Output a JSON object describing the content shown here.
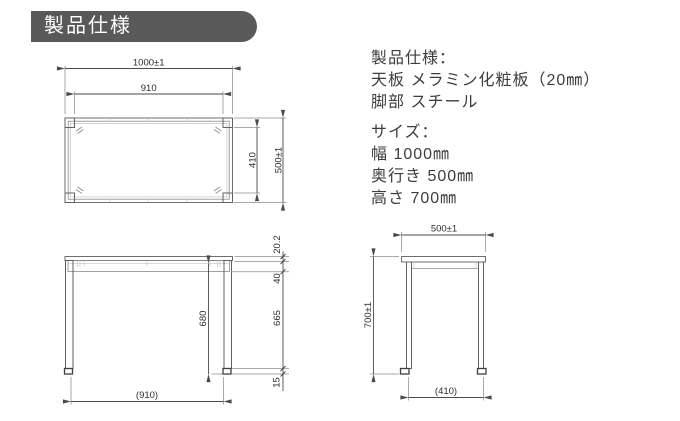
{
  "header": {
    "title": "製品仕様"
  },
  "specs": {
    "heading": "製品仕様：",
    "material_lines": [
      "天板 メラミン化粧板（20㎜）",
      "脚部 スチール"
    ],
    "size_heading": "サイズ：",
    "size_lines": [
      "幅 1000㎜",
      "奥行き 500㎜",
      "高さ 700㎜"
    ]
  },
  "colors": {
    "badge_background": "#595959",
    "badge_text": "#ffffff",
    "line_work": "#6e6e6e",
    "body_text": "#3d3d3d"
  },
  "drawings": {
    "top_view": {
      "dim_width_total": "1000±1",
      "dim_width_inner": "910",
      "dim_depth_inner": "410",
      "dim_depth_total": "500±1"
    },
    "front_view": {
      "dim_top_thickness": "20.2",
      "dim_apron_height": "40",
      "dim_leg_length": "665",
      "dim_foot_height": "15",
      "dim_underside_height": "680",
      "dim_leg_span": "(910)"
    },
    "side_view": {
      "dim_depth_total": "500±1",
      "dim_height_total": "700±1",
      "dim_leg_span": "(410)"
    }
  }
}
